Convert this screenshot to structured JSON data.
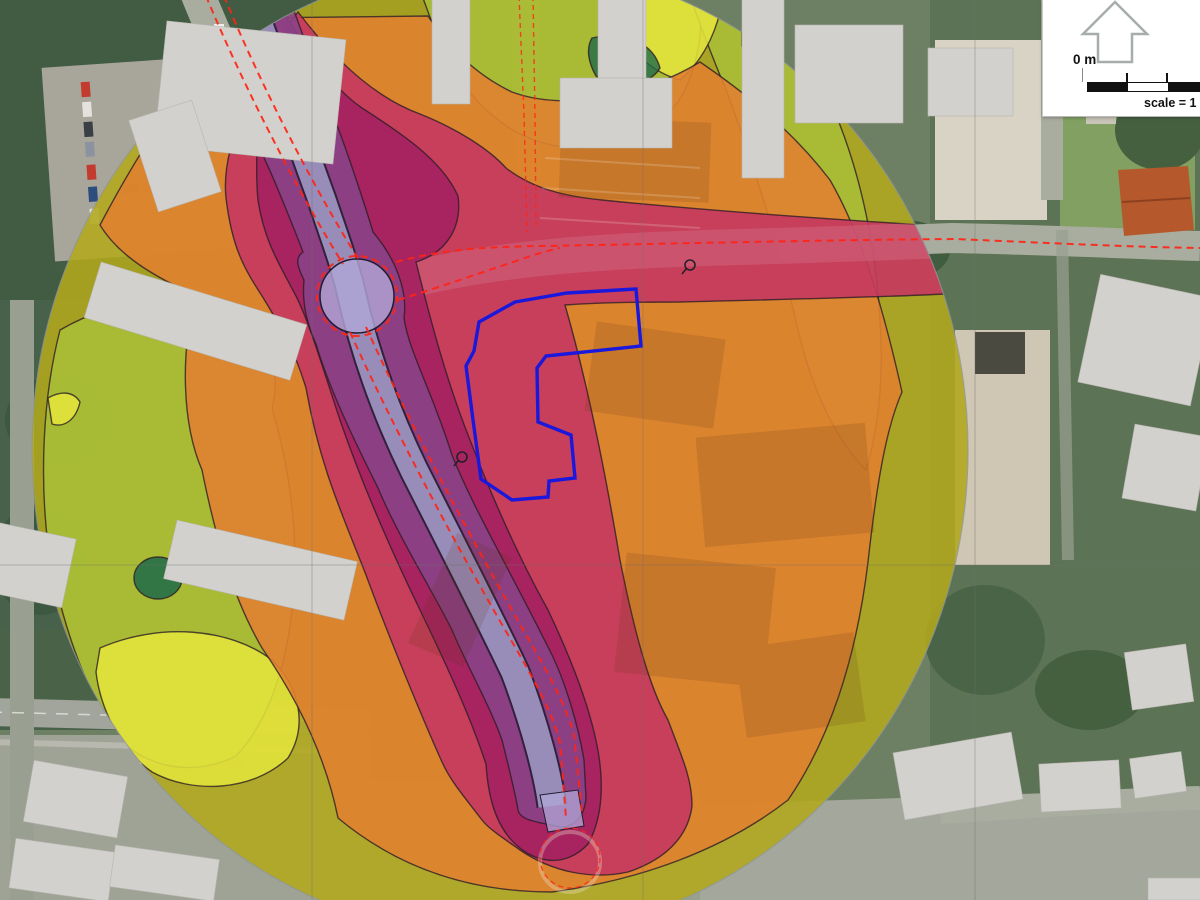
{
  "scale_panel": {
    "zero_label": "0 m",
    "scale_text": "scale = 1 :"
  },
  "colors": {
    "zone_olive": "#b2a81c",
    "zone_green": "#a9bf37",
    "zone_yellow": "#e4e43c",
    "zone_darkgreen": "#1f6a49",
    "zone_orange": "#e08130",
    "zone_crimson": "#c63a5e",
    "zone_road_pink": "#d4728c",
    "zone_magenta": "#a32160",
    "zone_purple": "#8b4387",
    "zone_lavender": "#b2a8d8",
    "site_boundary": "#1a18dd",
    "road_axis": "#ff2415",
    "grid": "#6f6f6f",
    "study_edge": "#8f959a",
    "building_fill": "#d3d1cd",
    "north_arrow": "#a7adad"
  }
}
